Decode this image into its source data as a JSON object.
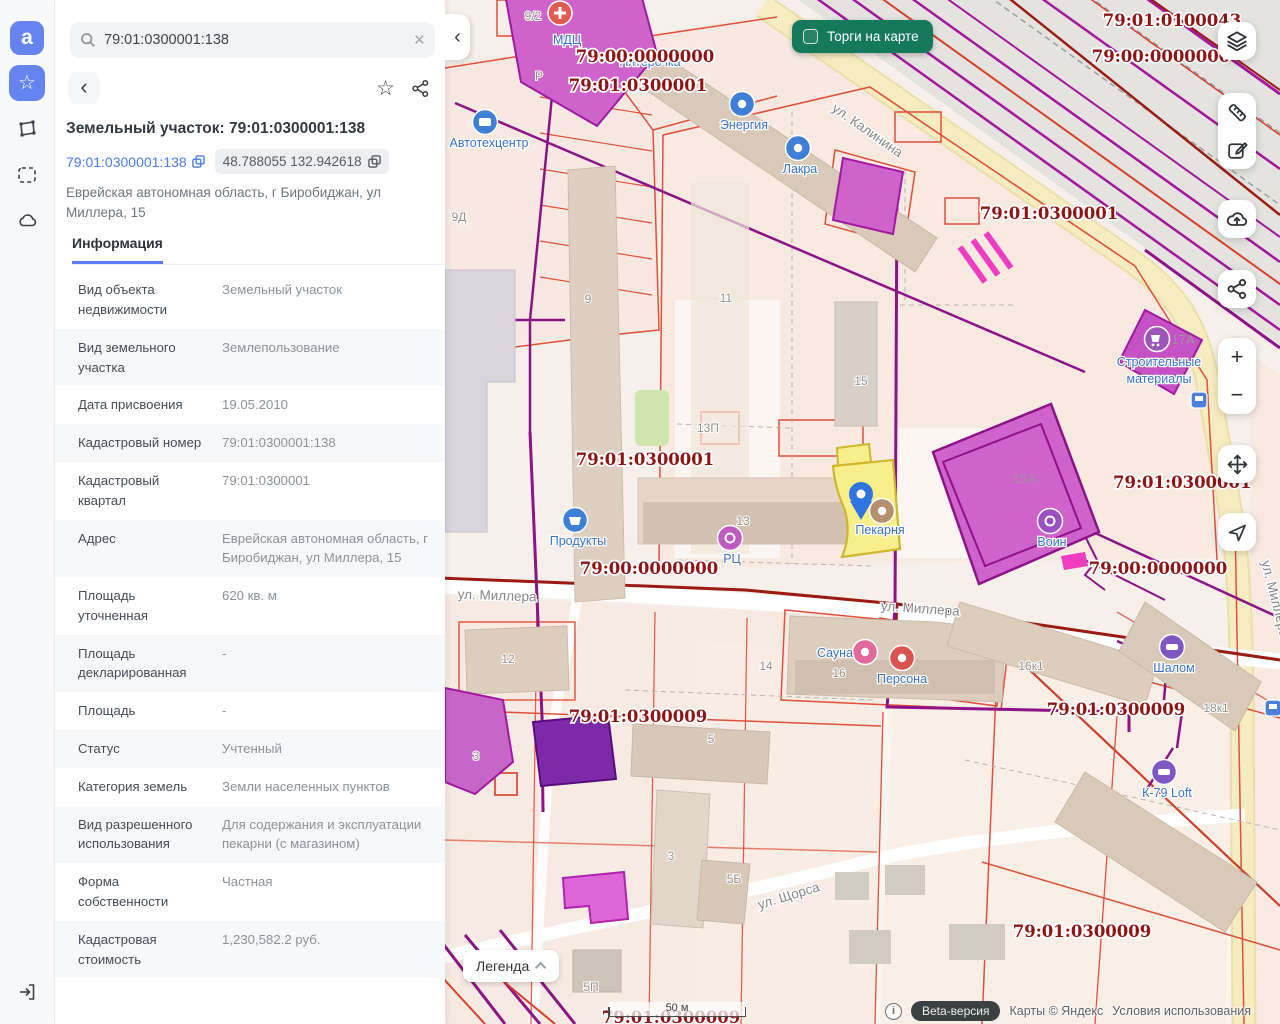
{
  "rail": {
    "logo_glyph": "a"
  },
  "sidebar": {
    "search": {
      "value": "79:01:0300001:138"
    },
    "title": "Земельный участок: 79:01:0300001:138",
    "cadastral_link": "79:01:0300001:138",
    "coordinates": "48.788055 132.942618",
    "address": "Еврейская автономная область, г Биробиджан, ул Миллера, 15",
    "tab_label": "Информация",
    "info_rows": [
      {
        "label": "Вид объекта недвижимости",
        "value": "Земельный участок"
      },
      {
        "label": "Вид земельного участка",
        "value": "Землепользование"
      },
      {
        "label": "Дата присвоения",
        "value": "19.05.2010"
      },
      {
        "label": "Кадастровый номер",
        "value": "79:01:0300001:138"
      },
      {
        "label": "Кадастровый квартал",
        "value": "79:01:0300001"
      },
      {
        "label": "Адрес",
        "value": "Еврейская автономная область, г Биробиджан, ул Миллера, 15"
      },
      {
        "label": "Площадь уточненная",
        "value": "620 кв. м"
      },
      {
        "label": "Площадь декларированная",
        "value": "-"
      },
      {
        "label": "Площадь",
        "value": "-"
      },
      {
        "label": "Статус",
        "value": "Учтенный"
      },
      {
        "label": "Категория земель",
        "value": "Земли населенных пунктов"
      },
      {
        "label": "Вид разрешенного использования",
        "value": "Для содержания и эксплуатации пекарни (с магазином)"
      },
      {
        "label": "Форма собственности",
        "value": "Частная"
      },
      {
        "label": "Кадастровая стоимость",
        "value": "1,230,582.2 руб."
      }
    ]
  },
  "map": {
    "toggle_label": "Торги на карте",
    "legend_label": "Легенда",
    "scale_label": "50 м",
    "beta_label": "Beta-версия",
    "copyright": "Карты © Яндекс",
    "terms": "Условия использования",
    "info_glyph": "i",
    "quarter_labels": [
      "79:01:0100043",
      "79:00:0000000",
      "79:00:0000000",
      "79:01:0300001",
      "79:01:0300001",
      "79:01:0300001",
      "79:00:0000000",
      "79:00:0000000",
      "79:01:0300001",
      "79:01:0300009",
      "79:01:0300009",
      "79:01:0300009",
      "79:01:0300009"
    ],
    "street_labels": [
      "ул. Калинина",
      "ул. Миллера",
      "ул. Миллера",
      "ул. Щорса",
      "ул. Миллера"
    ],
    "building_labels": [
      "9/2",
      "Р",
      "9Д",
      "9",
      "11",
      "15",
      "13П",
      "13",
      "15А",
      "17А",
      "12",
      "14",
      "16",
      "16к1",
      "5",
      "3",
      "5Б",
      "5П",
      "18к1",
      "3"
    ],
    "pois": [
      {
        "label": "МДЦ",
        "icon": "medical-cross"
      },
      {
        "label": "Пятёрочка",
        "icon": "store"
      },
      {
        "label": "Энергия",
        "icon": "energy"
      },
      {
        "label": "Лакра",
        "icon": "store"
      },
      {
        "label": "Автотехцентр",
        "icon": "car-service"
      },
      {
        "label": "Продукты",
        "icon": "grocery"
      },
      {
        "label": "РЦ",
        "icon": "center"
      },
      {
        "label": "Пекарня",
        "icon": "bakery"
      },
      {
        "label": "Воин",
        "icon": "memorial"
      },
      {
        "label": "Сауна",
        "icon": "sauna"
      },
      {
        "label": "Персона",
        "icon": "dentist"
      },
      {
        "label": "Шалом",
        "icon": "hotel"
      },
      {
        "label": "К-79 Loft",
        "icon": "hotel"
      },
      {
        "label_line1": "Строительные",
        "label_line2": "материалы",
        "icon": "building-materials"
      }
    ],
    "colors": {
      "accent_blue": "#6584f0",
      "link_blue": "#4a7df5",
      "parcel_red": "#e0503a",
      "quarter_label_red": "#8e1414",
      "utility_purple": "#8d1287",
      "selected_parcel_yellow": "#f8ee8c",
      "toggle_green": "#15795c"
    }
  }
}
